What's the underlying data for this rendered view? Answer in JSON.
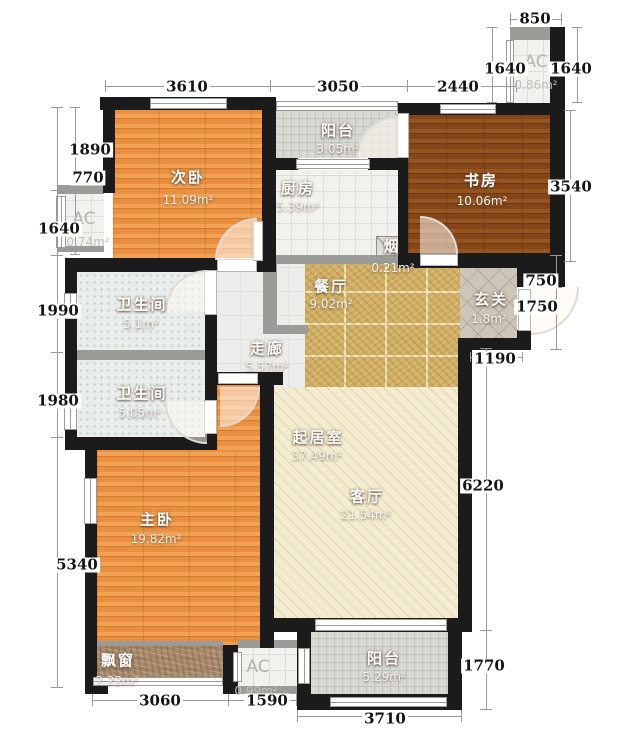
{
  "plan": {
    "type": "residential-floor-plan",
    "canvas": {
      "w": 633,
      "h": 730
    },
    "colors": {
      "wall": "#1b1b1b",
      "gray_wall": "#9b9b98",
      "dim_text": "#141414",
      "wood_orange": "#e98f42",
      "wood_dark": "#8a4a1c",
      "marble_gold": "#d0ae62",
      "cream": "#f4ecd1",
      "tile_gray": "#d8d8d3",
      "bath_tile": "#e9edec"
    },
    "rooms": [
      {
        "id": "ciwo",
        "name": "次卧",
        "area": "11.09m²",
        "floor": "wood",
        "rect": [
          113,
          110,
          149,
          148
        ],
        "label": [
          188,
          177
        ],
        "label2": [
          188,
          200
        ]
      },
      {
        "id": "yangtai-top",
        "name": "阳台",
        "area": "3.05m²",
        "floor": "tile",
        "rect": [
          276,
          111,
          122,
          47
        ],
        "label": [
          338,
          130
        ],
        "label2": [
          338,
          149
        ]
      },
      {
        "id": "chufang",
        "name": "厨房",
        "area": "5.39m²",
        "floor": "tile-light",
        "rect": [
          276,
          170,
          122,
          85
        ],
        "label": [
          298,
          188
        ],
        "label2": [
          298,
          207
        ]
      },
      {
        "id": "shufang",
        "name": "书房",
        "area": "10.06m²",
        "floor": "wood-dark",
        "rect": [
          408,
          115,
          142,
          138
        ],
        "label": [
          481,
          180
        ],
        "label2": [
          482,
          201
        ]
      },
      {
        "id": "ac-top-right",
        "name": "AC",
        "area": "0.86m²",
        "floor": "tile-light",
        "gray": true,
        "rect": [
          512,
          38,
          38,
          65
        ],
        "label": [
          536,
          62
        ],
        "label2": [
          536,
          85
        ]
      },
      {
        "id": "ac-left",
        "name": "AC",
        "area": "0.74m²",
        "floor": "tile-light",
        "gray": true,
        "rect": [
          60,
          193,
          44,
          55
        ],
        "label": [
          84,
          219
        ],
        "label2": [
          88,
          242
        ]
      },
      {
        "id": "yan",
        "name": "烟",
        "area": "0.21m²",
        "floor": "flue",
        "rect": [
          376,
          236,
          32,
          32
        ],
        "label": [
          392,
          246
        ],
        "label2": [
          393,
          268
        ]
      },
      {
        "id": "canting",
        "name": "餐厅",
        "area": "9.02m²",
        "floor": "marble",
        "rect": [
          305,
          263,
          155,
          124
        ],
        "label": [
          331,
          286
        ],
        "label2": [
          331,
          304
        ]
      },
      {
        "id": "xuanguan",
        "name": "玄关",
        "area": "1.8m²",
        "floor": "lattice",
        "rect": [
          460,
          263,
          57,
          75
        ],
        "label": [
          491,
          299
        ],
        "label2": [
          489,
          319
        ]
      },
      {
        "id": "zoulang",
        "name": "走廊",
        "area": "5.57m²",
        "floor": "plain",
        "rect": [
          217,
          263,
          88,
          124
        ],
        "label": [
          267,
          348
        ],
        "label2": [
          267,
          367
        ]
      },
      {
        "id": "weishengjian-1",
        "name": "卫生间",
        "area": "5.1m²",
        "floor": "dots",
        "rect": [
          77,
          272,
          128,
          78
        ],
        "label": [
          142,
          304
        ],
        "label2": [
          141,
          324
        ]
      },
      {
        "id": "weishengjian-2",
        "name": "卫生间",
        "area": "5.05m²",
        "floor": "dots",
        "rect": [
          77,
          360,
          128,
          77
        ],
        "label": [
          142,
          393
        ],
        "label2": [
          140,
          413
        ]
      },
      {
        "id": "zhuwo-upper",
        "name": "",
        "area": "",
        "floor": "wood",
        "rect": [
          217,
          385,
          43,
          65
        ],
        "label": null,
        "label2": null
      },
      {
        "id": "zhuwo",
        "name": "主卧",
        "area": "19.82m²",
        "floor": "wood",
        "rect": [
          97,
          450,
          163,
          196
        ],
        "label": [
          157,
          519
        ],
        "label2": [
          156,
          539
        ]
      },
      {
        "id": "qijushi",
        "name": "起居室",
        "area": "37.49m²",
        "floor": "cream",
        "rect": [
          274,
          387,
          184,
          231
        ],
        "label": [
          318,
          437
        ],
        "label2": [
          317,
          456
        ]
      },
      {
        "id": "keting",
        "name": "客厅",
        "area": "21.54m²",
        "floor": null,
        "rect": null,
        "label": [
          367,
          496
        ],
        "label2": [
          366,
          515
        ]
      },
      {
        "id": "piaochuang",
        "name": "飘窗",
        "area": "2.22m²",
        "floor": "stone",
        "rect": [
          93,
          645,
          130,
          37
        ],
        "label": [
          118,
          660
        ],
        "label2": [
          117,
          681
        ]
      },
      {
        "id": "ac-bottom",
        "name": "AC",
        "area": "0.99m²",
        "floor": "tile-light",
        "gray": true,
        "rect": [
          238,
          648,
          61,
          38
        ],
        "label": [
          258,
          667
        ],
        "label2": [
          256,
          691
        ]
      },
      {
        "id": "yangtai-bottom",
        "name": "阳台",
        "area": "5.29m²",
        "floor": "tile",
        "rect": [
          311,
          632,
          137,
          62
        ],
        "label": [
          384,
          658
        ],
        "label2": [
          384,
          677
        ]
      }
    ],
    "dimensions": [
      {
        "t": "3610",
        "x": 187,
        "y": 87
      },
      {
        "t": "3050",
        "x": 338,
        "y": 87
      },
      {
        "t": "2440",
        "x": 458,
        "y": 87
      },
      {
        "t": "850",
        "x": 535,
        "y": 19
      },
      {
        "t": "1640",
        "x": 505,
        "y": 69
      },
      {
        "t": "1640",
        "x": 571,
        "y": 69
      },
      {
        "t": "1890",
        "x": 90,
        "y": 150
      },
      {
        "t": "770",
        "x": 88,
        "y": 178
      },
      {
        "t": "1640",
        "x": 59,
        "y": 229
      },
      {
        "t": "1990",
        "x": 58,
        "y": 311
      },
      {
        "t": "1980",
        "x": 58,
        "y": 401
      },
      {
        "t": "5340",
        "x": 77,
        "y": 565
      },
      {
        "t": "3540",
        "x": 571,
        "y": 187
      },
      {
        "t": "750",
        "x": 541,
        "y": 281
      },
      {
        "t": "1750",
        "x": 537,
        "y": 307
      },
      {
        "t": "1190",
        "x": 495,
        "y": 359
      },
      {
        "t": "6220",
        "x": 483,
        "y": 486
      },
      {
        "t": "1770",
        "x": 484,
        "y": 666
      },
      {
        "t": "3060",
        "x": 160,
        "y": 701
      },
      {
        "t": "1590",
        "x": 267,
        "y": 701
      },
      {
        "t": "3710",
        "x": 385,
        "y": 719
      }
    ],
    "structure": {
      "walls": [
        [
          100,
          97,
          176,
          13
        ],
        [
          398,
          103,
          152,
          12
        ],
        [
          550,
          27,
          15,
          241
        ],
        [
          262,
          109,
          14,
          149
        ],
        [
          398,
          103,
          10,
          165
        ],
        [
          398,
          253,
          167,
          15
        ],
        [
          517,
          255,
          48,
          32
        ],
        [
          517,
          330,
          14,
          20
        ],
        [
          458,
          338,
          73,
          12
        ],
        [
          458,
          338,
          14,
          294
        ],
        [
          276,
          158,
          22,
          12
        ],
        [
          368,
          158,
          30,
          12
        ],
        [
          65,
          258,
          152,
          14
        ],
        [
          257,
          258,
          19,
          14
        ],
        [
          65,
          258,
          12,
          187
        ],
        [
          205,
          262,
          12,
          183
        ],
        [
          65,
          437,
          145,
          13
        ],
        [
          205,
          372,
          12,
          78
        ],
        [
          205,
          372,
          78,
          13
        ],
        [
          260,
          372,
          14,
          276
        ],
        [
          85,
          437,
          12,
          257
        ],
        [
          85,
          680,
          23,
          14
        ],
        [
          223,
          645,
          15,
          49
        ],
        [
          274,
          618,
          198,
          14
        ],
        [
          297,
          632,
          14,
          74
        ],
        [
          297,
          694,
          165,
          16
        ],
        [
          448,
          632,
          14,
          78
        ],
        [
          103,
          97,
          12,
          96
        ]
      ],
      "gray_walls": [
        [
          510,
          27,
          40,
          13
        ],
        [
          58,
          185,
          46,
          9
        ],
        [
          58,
          246,
          46,
          6
        ],
        [
          276,
          255,
          132,
          9
        ],
        [
          263,
          262,
          14,
          72
        ],
        [
          277,
          325,
          31,
          9
        ],
        [
          65,
          350,
          152,
          10
        ],
        [
          238,
          640,
          61,
          8
        ],
        [
          238,
          686,
          61,
          8
        ],
        [
          93,
          641,
          130,
          5
        ]
      ],
      "windows": [
        [
          150,
          98,
          77,
          11,
          "h"
        ],
        [
          440,
          104,
          56,
          10,
          "h"
        ],
        [
          276,
          101,
          122,
          10,
          "h"
        ],
        [
          296,
          159,
          74,
          10,
          "h"
        ],
        [
          56,
          196,
          10,
          52,
          "v"
        ],
        [
          506,
          40,
          8,
          63,
          "v"
        ],
        [
          64,
          293,
          13,
          26,
          "v"
        ],
        [
          64,
          399,
          13,
          31,
          "v"
        ],
        [
          84,
          478,
          13,
          46,
          "v"
        ],
        [
          93,
          677,
          130,
          9,
          "h"
        ],
        [
          233,
          652,
          9,
          30,
          "v"
        ],
        [
          298,
          648,
          12,
          36,
          "v"
        ],
        [
          315,
          619,
          132,
          12,
          "h"
        ],
        [
          330,
          697,
          117,
          10,
          "h"
        ]
      ],
      "gaps": [
        [
          217,
          259,
          40,
          13
        ],
        [
          253,
          221,
          10,
          40
        ],
        [
          397,
          113,
          12,
          45
        ],
        [
          420,
          254,
          38,
          12
        ],
        [
          204,
          270,
          13,
          45
        ],
        [
          204,
          400,
          13,
          34
        ],
        [
          218,
          373,
          40,
          11
        ],
        [
          518,
          289,
          13,
          42
        ]
      ],
      "doors": [
        [
          215,
          218,
          42,
          42,
          "tl"
        ],
        [
          356,
          116,
          42,
          42,
          "tl"
        ],
        [
          420,
          216,
          38,
          38,
          "tr"
        ],
        [
          165,
          270,
          42,
          42,
          "tl"
        ],
        [
          165,
          402,
          42,
          42,
          "bl"
        ],
        [
          220,
          387,
          40,
          40,
          "br"
        ],
        [
          531,
          287,
          48,
          48,
          "br"
        ]
      ],
      "dim_lines": [
        [
          105,
          86,
          411,
          1
        ],
        [
          105,
          80,
          1,
          12
        ],
        [
          270,
          80,
          1,
          12
        ],
        [
          407,
          80,
          1,
          12
        ],
        [
          516,
          80,
          1,
          12
        ],
        [
          510,
          19,
          52,
          1
        ],
        [
          510,
          13,
          1,
          12
        ],
        [
          561,
          13,
          1,
          12
        ],
        [
          492,
          27,
          1,
          76
        ],
        [
          577,
          27,
          1,
          76
        ],
        [
          487,
          27,
          10,
          1
        ],
        [
          487,
          102,
          10,
          1
        ],
        [
          572,
          27,
          10,
          1
        ],
        [
          572,
          102,
          10,
          1
        ],
        [
          57,
          107,
          1,
          581
        ],
        [
          51,
          107,
          12,
          1
        ],
        [
          51,
          190,
          12,
          1
        ],
        [
          51,
          255,
          12,
          1
        ],
        [
          51,
          352,
          12,
          1
        ],
        [
          51,
          437,
          12,
          1
        ],
        [
          51,
          687,
          12,
          1
        ],
        [
          75,
          107,
          1,
          148
        ],
        [
          70,
          107,
          10,
          1
        ],
        [
          70,
          190,
          10,
          1
        ],
        [
          70,
          222,
          10,
          1
        ],
        [
          70,
          254,
          10,
          1
        ],
        [
          570,
          110,
          1,
          152
        ],
        [
          564,
          110,
          12,
          1
        ],
        [
          564,
          261,
          12,
          1
        ],
        [
          556,
          255,
          1,
          95
        ],
        [
          550,
          255,
          12,
          1
        ],
        [
          550,
          287,
          12,
          1
        ],
        [
          550,
          349,
          12,
          1
        ],
        [
          470,
          357,
          53,
          1
        ],
        [
          470,
          352,
          1,
          10
        ],
        [
          522,
          352,
          1,
          10
        ],
        [
          486,
          348,
          1,
          362
        ],
        [
          480,
          348,
          12,
          1
        ],
        [
          480,
          630,
          12,
          1
        ],
        [
          480,
          709,
          12,
          1
        ],
        [
          92,
          700,
          205,
          1
        ],
        [
          92,
          694,
          1,
          12
        ],
        [
          228,
          694,
          1,
          12
        ],
        [
          296,
          694,
          1,
          12
        ],
        [
          297,
          716,
          165,
          1
        ],
        [
          297,
          710,
          1,
          12
        ],
        [
          461,
          710,
          1,
          12
        ]
      ]
    }
  }
}
